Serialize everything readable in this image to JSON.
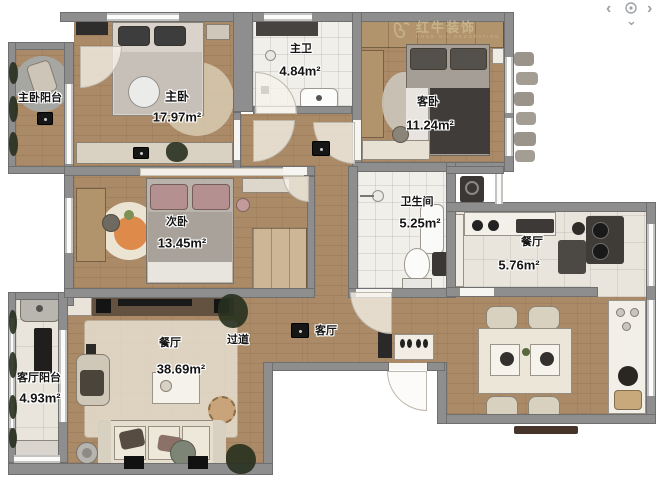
{
  "watermark": {
    "brand": "红牛装饰",
    "subtext": "HONG NIU DECORATION"
  },
  "controls": {
    "pan_left": "‹",
    "pan_right": "›",
    "pan_down": "⌄"
  },
  "rooms": [
    {
      "name": "主卧阳台",
      "area": ""
    },
    {
      "name": "主卧",
      "area": "17.97m²"
    },
    {
      "name": "主卫",
      "area": "4.84m²"
    },
    {
      "name": "客卧",
      "area": "11.24m²"
    },
    {
      "name": "次卧",
      "area": "13.45m²"
    },
    {
      "name": "卫生间",
      "area": "5.25m²"
    },
    {
      "name": "餐厅",
      "area": "5.76m²"
    },
    {
      "name": "客厅阳台",
      "area": "4.93m²"
    },
    {
      "name": "餐厅",
      "area": "38.69m²"
    },
    {
      "name": "过道",
      "area": ""
    },
    {
      "name": "客厅",
      "area": ""
    }
  ],
  "colors": {
    "wall": "#8e8e8e",
    "wood_floor": "#aa8a67",
    "tile_floor": "#f1efea",
    "watermark": "#c9b58d",
    "nav_icons": "#9ca1a8",
    "label_text": "#141414"
  }
}
